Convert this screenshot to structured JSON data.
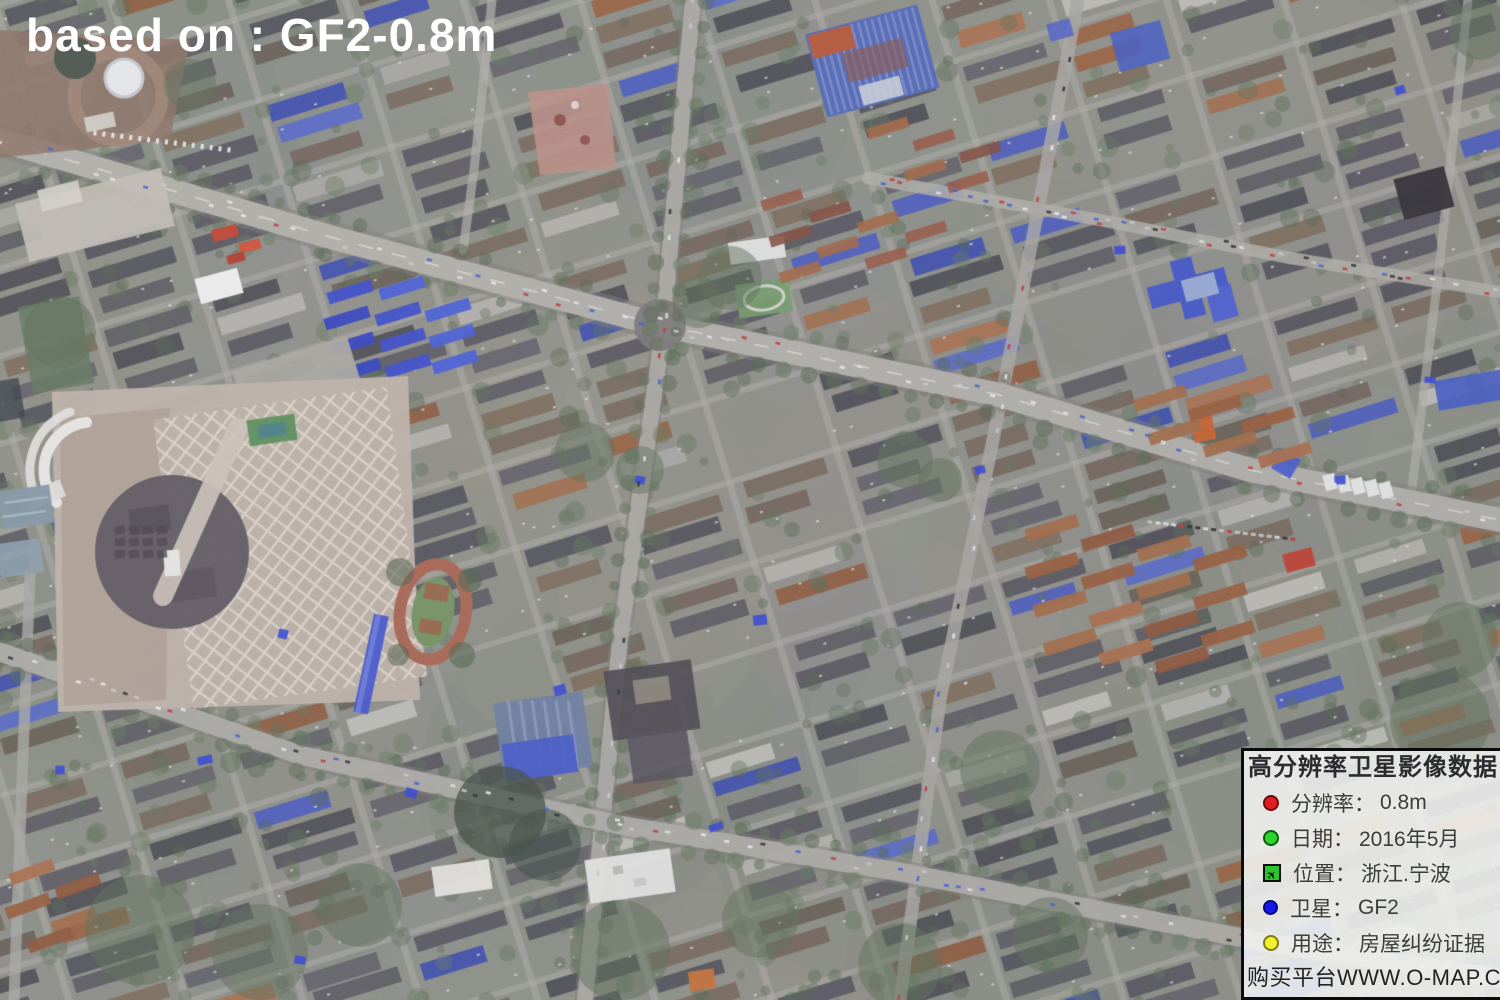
{
  "overlay": {
    "caption": "based on : GF2-0.8m"
  },
  "panel": {
    "title": "高分辨率卫星影像数据",
    "items": [
      {
        "icon": "red-dot",
        "icon_color": "#e31b23",
        "label": "分辨率：",
        "value": "0.8m"
      },
      {
        "icon": "green-dot",
        "icon_color": "#2ed32e",
        "label": "日期：",
        "value": "2016年5月"
      },
      {
        "icon": "green-square-plane",
        "icon_color": "#2ec42e",
        "glyph": "✈",
        "label": "位置：",
        "value": "浙江.宁波"
      },
      {
        "icon": "blue-dot",
        "icon_color": "#1619e6",
        "label": "卫星：",
        "value": "GF2"
      },
      {
        "icon": "yellow-dot",
        "icon_color": "#f0ee2e",
        "label": "用途：",
        "value": "房屋纠纷证据"
      }
    ],
    "footer": "购买平台WWW.O-MAP.CN"
  },
  "map": {
    "type": "satellite-imagery",
    "palette": {
      "ground": "#8a8d81",
      "road": "#b1afa7",
      "roof_dark": "#46444d",
      "roof_brown": "#6b5a4e",
      "roof_orange": "#9c5a36",
      "roof_blue": "#3a52c8",
      "vegetation": "#55684e",
      "construction": "#c0b3a6",
      "dirt": "#8a6c5c",
      "track": "#a85f49",
      "field": "#6e8f58",
      "water": "#7e93a2"
    }
  }
}
